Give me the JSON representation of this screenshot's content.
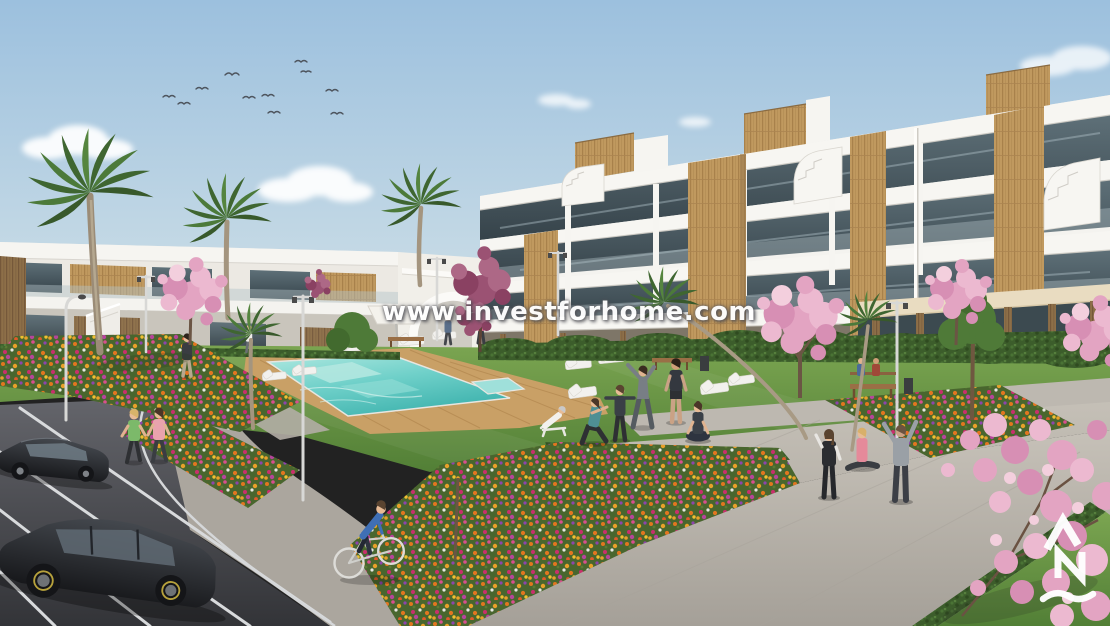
{
  "page": {
    "type": "architectural-rendering",
    "subject": "Modern white residential apartment complex with communal lawn, swimming pool, gardens, parking and people"
  },
  "watermark": {
    "text": "www.investforhome.com",
    "color": "#ffffff"
  },
  "logo": {
    "glyphs": "ΛN~",
    "description": "white developer monogram: caret above N above wave",
    "color": "#ffffff"
  },
  "palette": {
    "sky_top": "#9cc0de",
    "sky_horizon": "#e6edef",
    "building_white": "#f6f5f1",
    "wood_accent": "#c0995f",
    "glass": "#46555c",
    "lawn": "#6f9c49",
    "pool_water": "#62c6c0",
    "pool_deck": "#c9a066",
    "blossom_pink": "#e3a4c2",
    "flower_orange": "#e2761f",
    "flower_magenta": "#d94f8e",
    "path_gray": "#b9b4ac",
    "asphalt": "#4a4b4f",
    "car_dark": "#26282c"
  },
  "scene_elements": [
    "sky",
    "clouds",
    "flying-birds",
    "apartment-buildings",
    "rooftop-wood-penthouses",
    "palm-trees",
    "cherry-blossom-trees",
    "communal-lawn",
    "swimming-pool",
    "wooden-pool-deck",
    "sun-loungers",
    "white-parasol",
    "flower-beds",
    "hedges",
    "street-lamps",
    "benches",
    "people-exercising",
    "yoga-person",
    "joggers",
    "cyclist",
    "walkers",
    "parking-lot",
    "parked-cars",
    "pedestrian-paths"
  ]
}
